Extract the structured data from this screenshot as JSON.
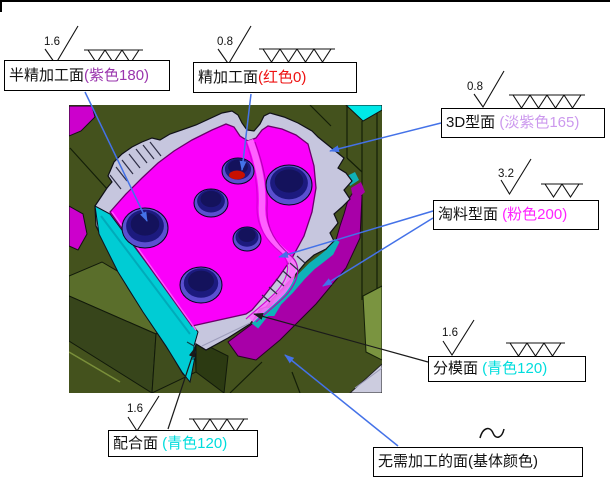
{
  "annotations": [
    {
      "id": "semi-finish",
      "label": "半精加工面",
      "paren": "(紫色180)",
      "paren_color": "#9a35ad",
      "roughness": "1.6",
      "grade_marks": 3
    },
    {
      "id": "finish",
      "label": "精加工面",
      "paren": "(红色0)",
      "paren_color": "#ee1111",
      "roughness": "0.8",
      "grade_marks": 4
    },
    {
      "id": "3d-surface",
      "label": "3D型面 ",
      "paren": "(淡紫色165)",
      "paren_color": "#cc99ee",
      "roughness": "0.8",
      "grade_marks": 4
    },
    {
      "id": "scrap-surface",
      "label": "淘料型面 ",
      "paren": "(粉色200)",
      "paren_color": "#ff22ff",
      "roughness": "3.2",
      "grade_marks": 2
    },
    {
      "id": "parting-surface",
      "label": "分模面 ",
      "paren": "(青色120)",
      "paren_color": "#00dddd",
      "roughness": "1.6",
      "grade_marks": 3
    },
    {
      "id": "fit-surface",
      "label": "配合面 ",
      "paren": "(青色120)",
      "paren_color": "#00dddd",
      "roughness": "1.6",
      "grade_marks": 3
    },
    {
      "id": "no-machining",
      "label": "无需加工的面(基体颜色)",
      "paren": "",
      "paren_color": "",
      "roughness": "",
      "grade_marks": 0,
      "symbol": "~"
    }
  ],
  "colors": {
    "leader_blue": "#4472e8",
    "leader_black": "#1a1a1a",
    "model_background_green": "#44521d",
    "top_surface_magenta": "#fa00fa",
    "rim_lavender": "#c6c6de",
    "side_cyan": "#00ccd4",
    "side_teal": "#0fb2b8",
    "side_purple": "#a800a8",
    "hole_navy": "#1c1a7e",
    "hole_violet": "#5a4fd0",
    "finish_red": "#c81000"
  }
}
